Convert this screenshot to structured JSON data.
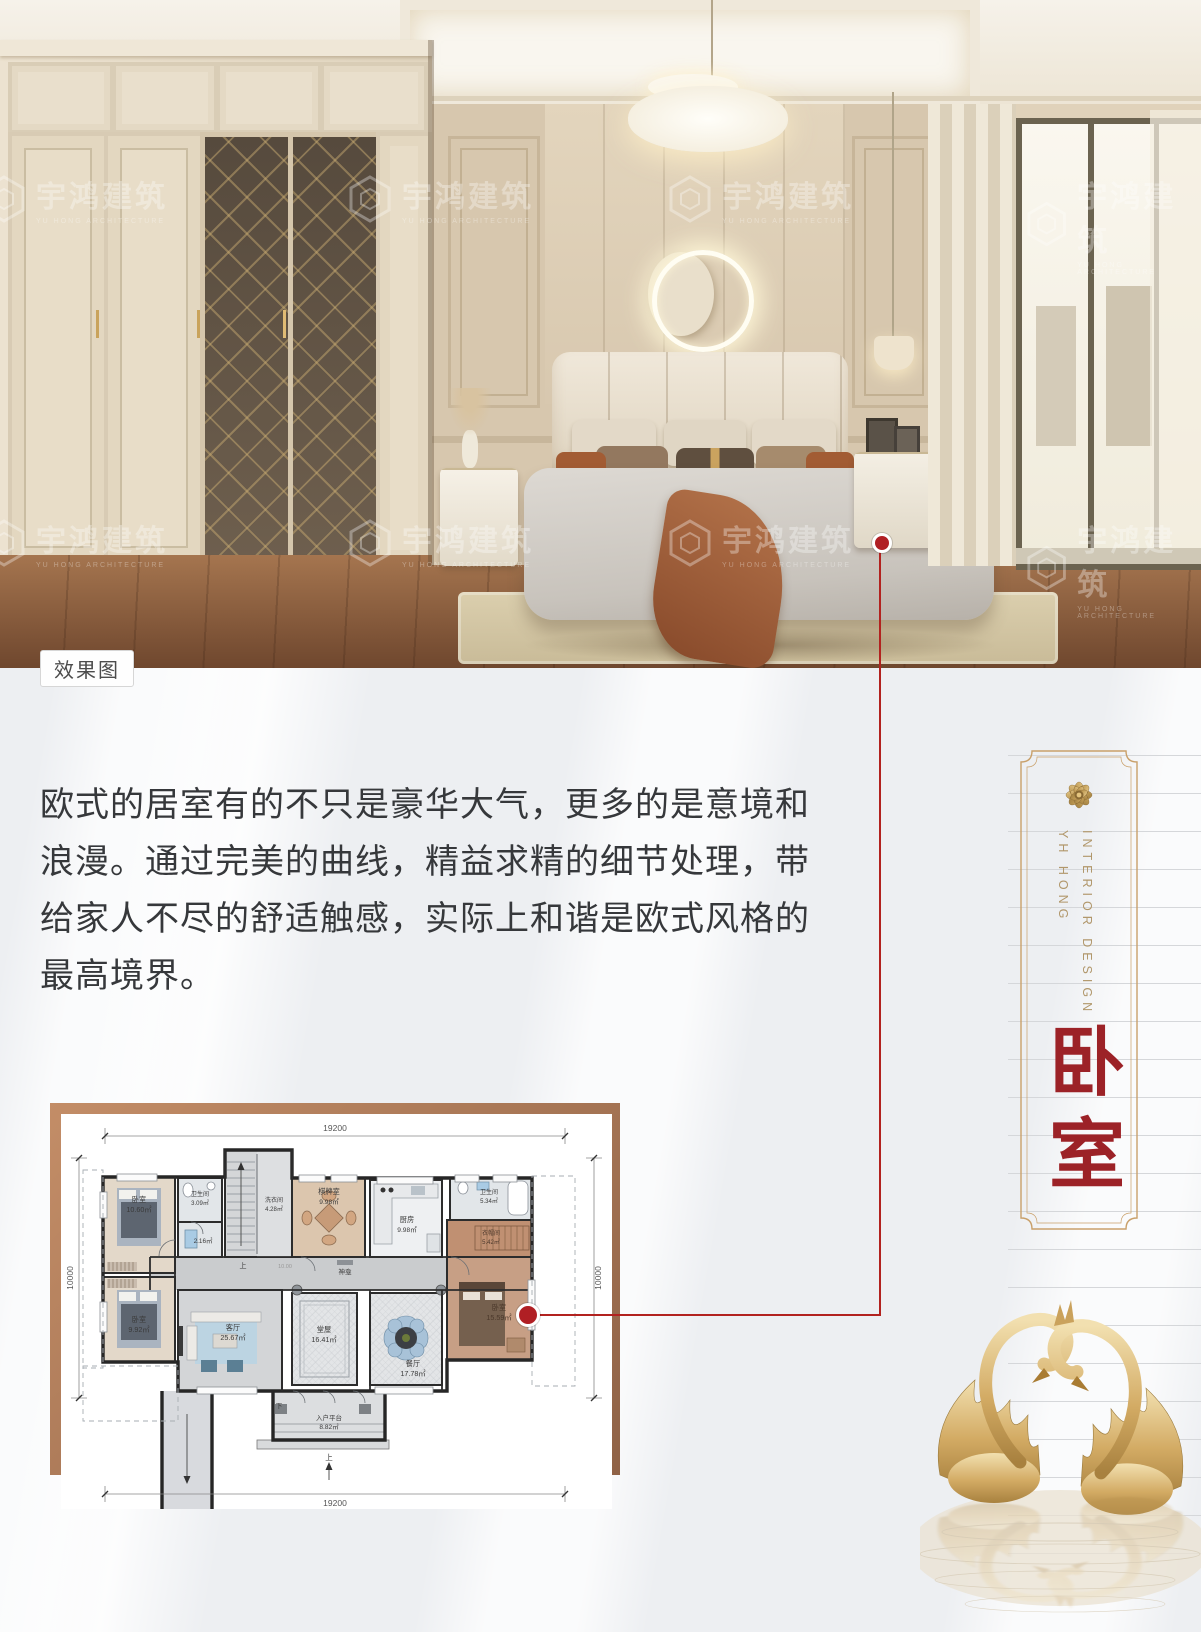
{
  "photo": {
    "label": "效果图",
    "watermark": {
      "name": "宇鸿建筑",
      "subtitle": "YU HONG ARCHITECTURE"
    }
  },
  "description": {
    "lines": [
      "欧式的居室有的不只是豪华大气，更多的是意境和",
      "浪漫。通过完美的曲线，精益求精的细节处理，带",
      "给家人不尽的舒适触感，实际上和谐是欧式风格的",
      "最高境界。"
    ]
  },
  "banner": {
    "en_line1": "INTERIOR DESIGN",
    "en_line2": "YH HONG",
    "title": "卧室"
  },
  "floorplan": {
    "dims": {
      "top": "19200",
      "bottom": "19200",
      "left": "10000",
      "right": "10000"
    },
    "rooms": [
      {
        "name": "卧室",
        "area": "10.60㎡"
      },
      {
        "name": "卫生间",
        "area": "3.09㎡"
      },
      {
        "name": "",
        "area": "2.16㎡"
      },
      {
        "name": "洗衣间",
        "area": "4.28㎡"
      },
      {
        "name": "棋牌室",
        "area": "9.98㎡"
      },
      {
        "name": "厨房",
        "area": "9.98㎡"
      },
      {
        "name": "卫生间",
        "area": "5.34㎡"
      },
      {
        "name": "衣帽间",
        "area": "5.42㎡"
      },
      {
        "name": "卧室",
        "area": "9.92㎡"
      },
      {
        "name": "客厅",
        "area": "25.67㎡"
      },
      {
        "name": "堂屋",
        "area": "16.41㎡"
      },
      {
        "name": "餐厅",
        "area": "17.78㎡"
      },
      {
        "name": "卧室",
        "area": "15.59㎡"
      },
      {
        "name": "入户平台",
        "area": "8.82㎡"
      }
    ],
    "labels": {
      "shrine": "神龛",
      "up": "上",
      "down": "下",
      "elevation": "10.00"
    }
  },
  "colors": {
    "accent_red": "#b01f24",
    "frame_gold": "#c9a069",
    "title_red": "#9c2227",
    "frame_brown": "#a9754f"
  }
}
